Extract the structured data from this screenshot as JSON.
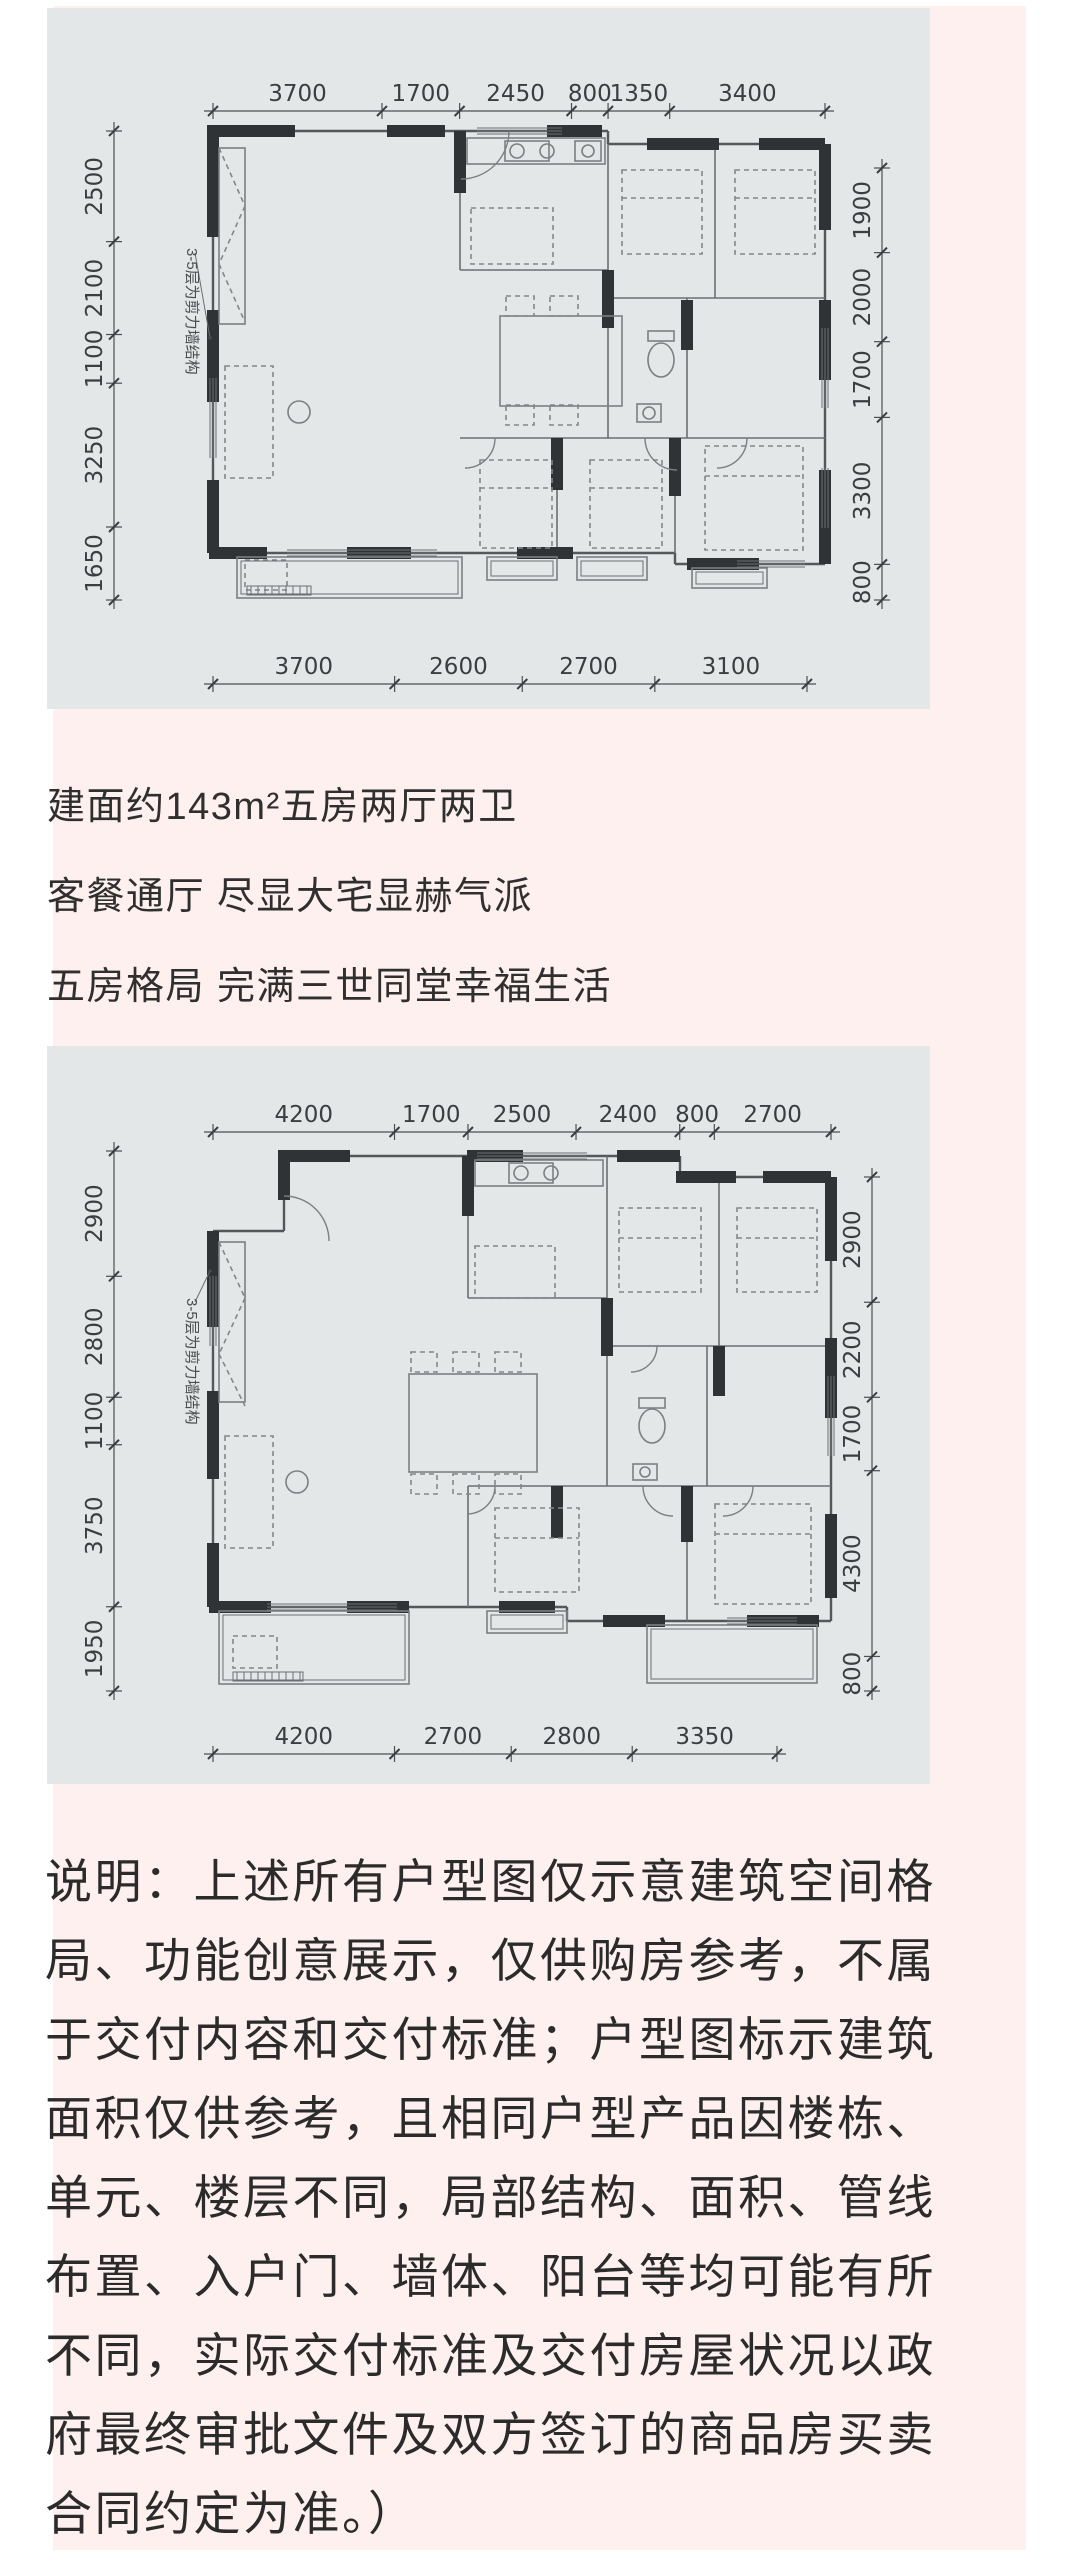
{
  "page": {
    "background": "#ffffff",
    "content_background": "#fdf0ee",
    "panel_background": "#e4e7e8",
    "wall_color": "#2f3336",
    "text_color": "#2f2f2f"
  },
  "headline": {
    "lines": [
      "建面约143m²五房两厅两卫",
      "客餐通厅 尽显大宅显赫气派",
      "五房格局 完满三世同堂幸福生活"
    ]
  },
  "floorplan1": {
    "annotation": "3-5层为剪力墙结构",
    "dims": {
      "top": [
        "3700",
        "1700",
        "2450",
        "800",
        "1350",
        "3400"
      ],
      "bottom": [
        "3700",
        "2600",
        "2700",
        "3100"
      ],
      "left": [
        "2500",
        "2100",
        "1100",
        "3250",
        "1650"
      ],
      "right": [
        "1900",
        "2000",
        "1700",
        "3300",
        "800"
      ]
    }
  },
  "floorplan2": {
    "annotation": "3-5层为剪力墙结构",
    "dims": {
      "top": [
        "4200",
        "1700",
        "2500",
        "2400",
        "800",
        "2700"
      ],
      "bottom": [
        "4200",
        "2700",
        "2800",
        "3350"
      ],
      "left": [
        "2900",
        "2800",
        "1100",
        "3750",
        "1950"
      ],
      "right": [
        "2900",
        "2200",
        "1700",
        "4300",
        "800"
      ]
    }
  },
  "disclaimer": {
    "lines": [
      "说明：上述所有户型图仅示意建筑空间格",
      "局、功能创意展示，仅供购房参考，不属",
      "于交付内容和交付标准；户型图标示建筑",
      "面积仅供参考，且相同户型产品因楼栋、",
      "单元、楼层不同，局部结构、面积、管线",
      "布置、入户门、墙体、阳台等均可能有所",
      "不同，实际交付标准及交付房屋状况以政",
      "府最终审批文件及双方签订的商品房买卖",
      "合同约定为准。）"
    ]
  }
}
